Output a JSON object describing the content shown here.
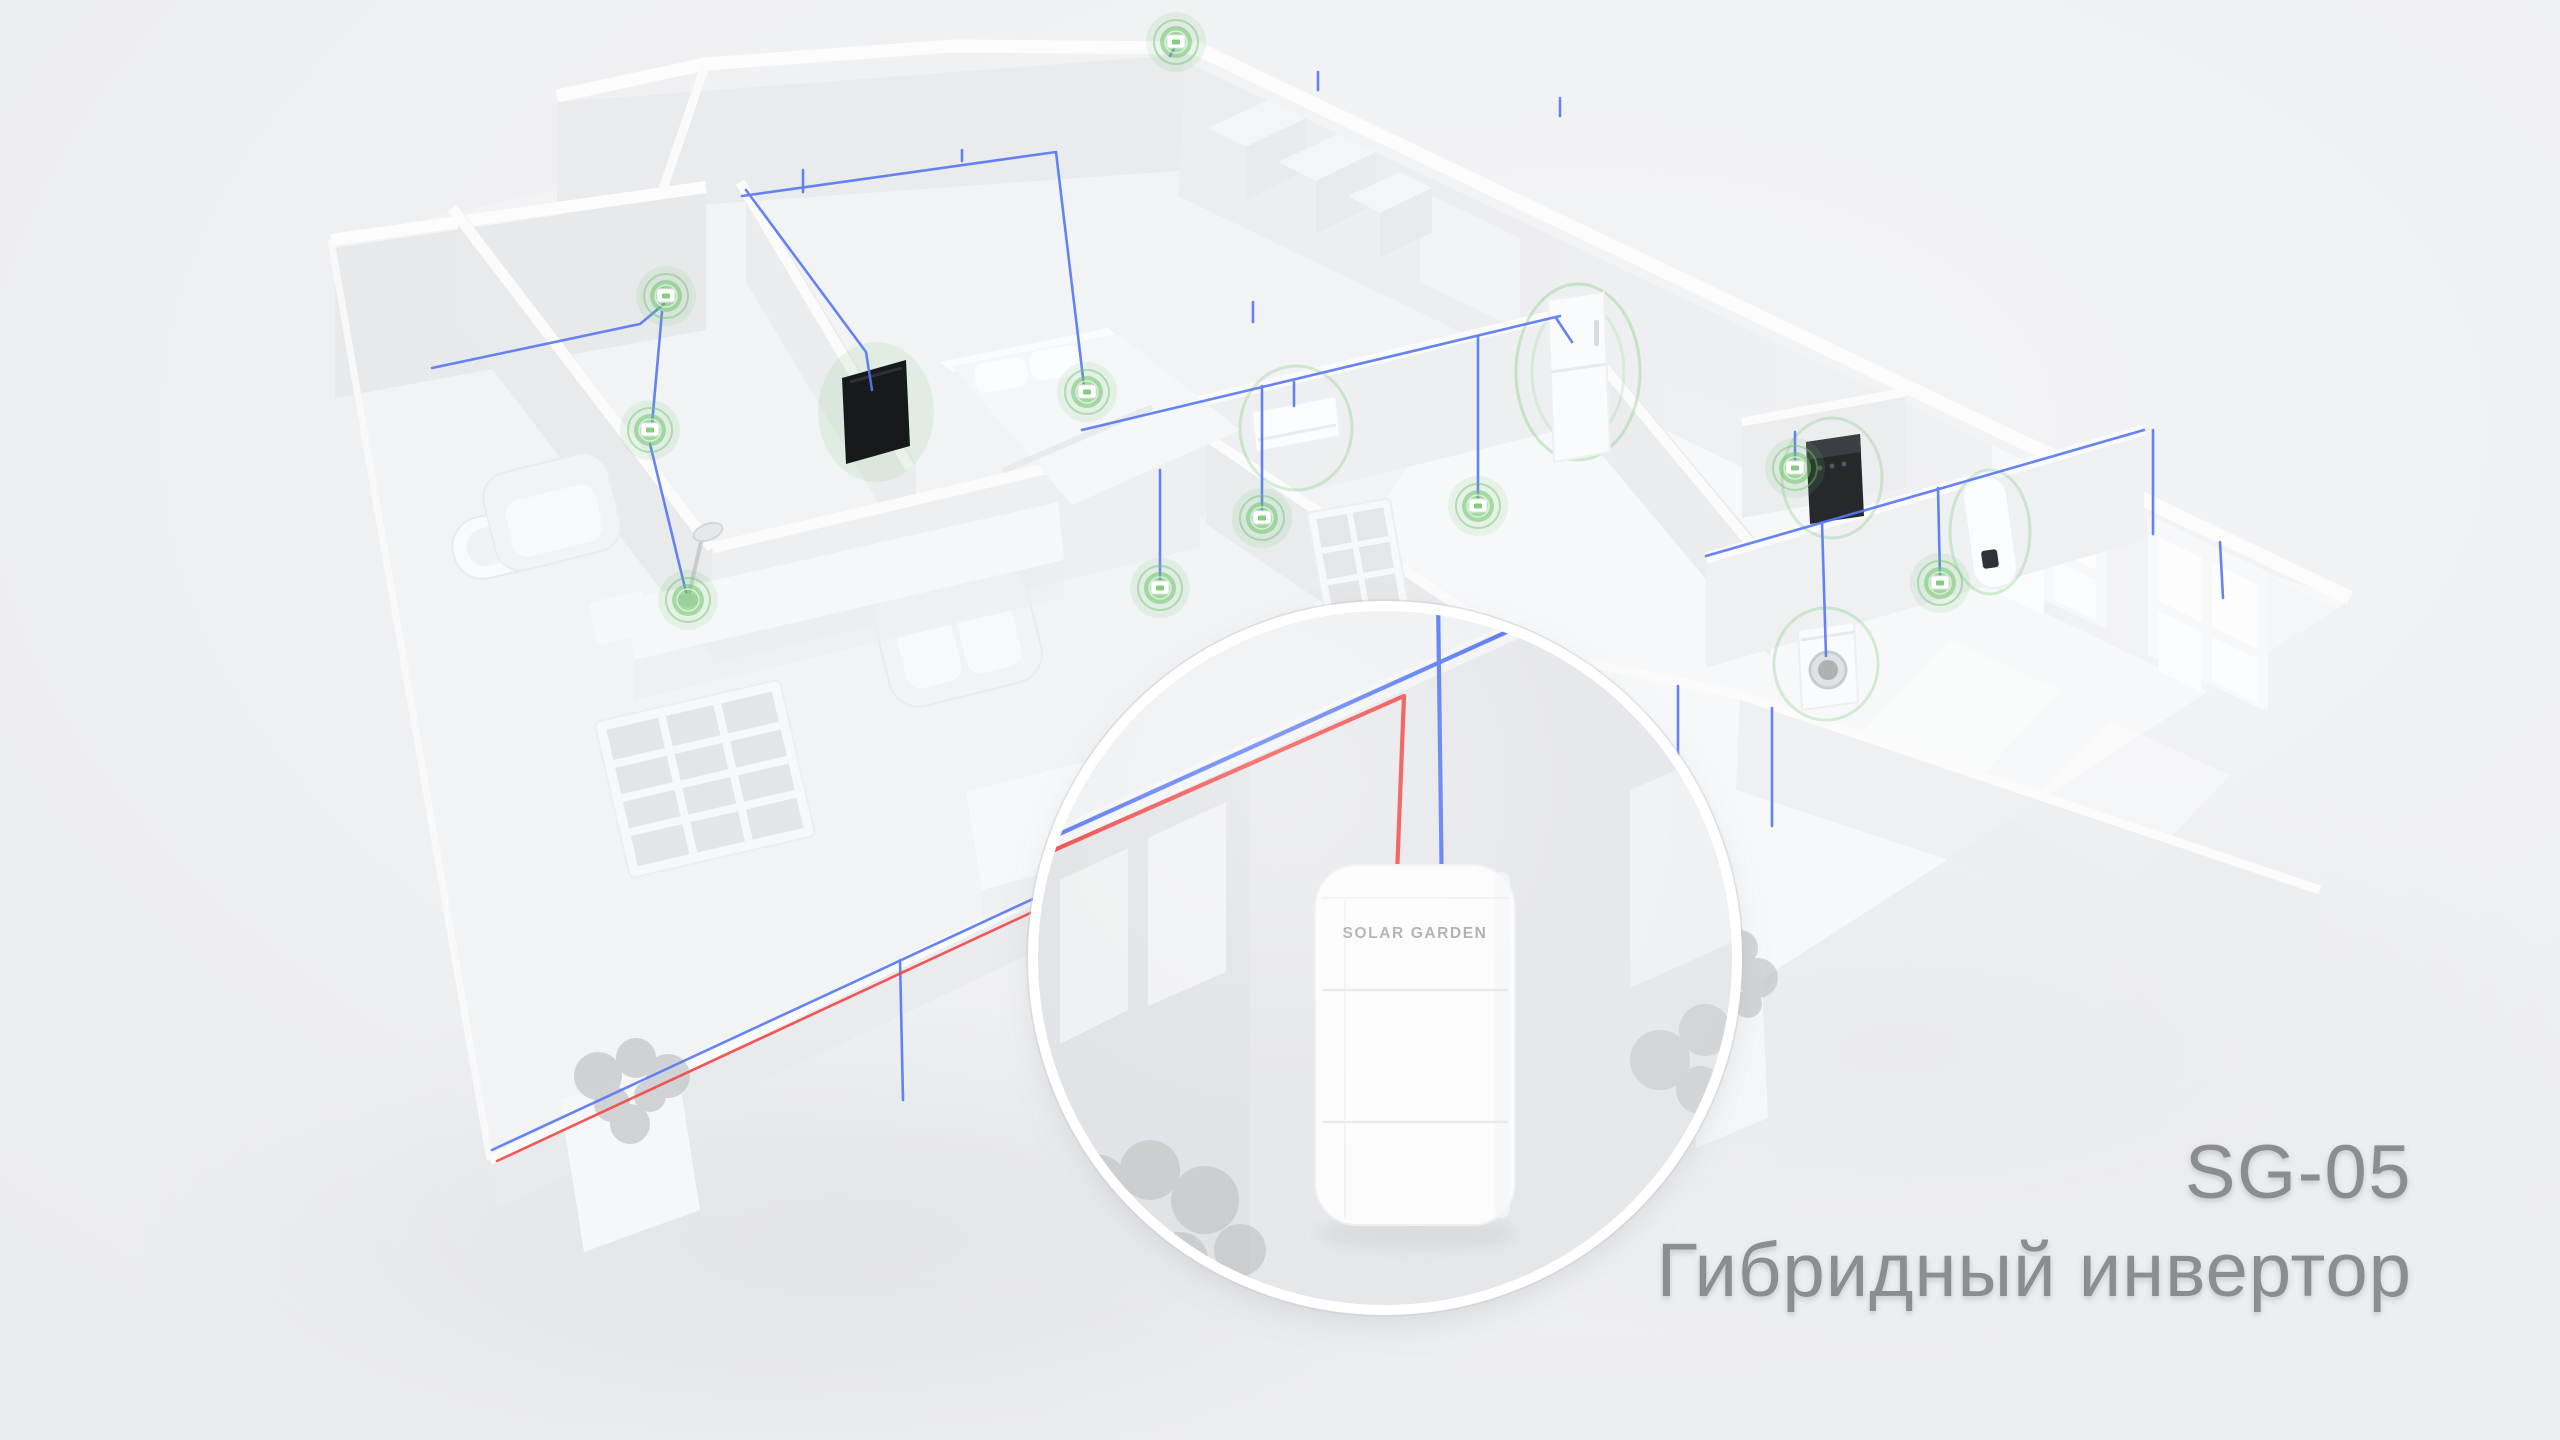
{
  "scene": {
    "background": "#eff0f2",
    "caption": {
      "model": "SG-05",
      "product": "Гибридный инвертор",
      "color": "#8c8d8f"
    },
    "inverter": {
      "brand": "SOLAR GARDEN",
      "brand_color": "#a8abad",
      "status_dots": [
        "#84c77e",
        "#bdc0c2",
        "#bdc0c2"
      ],
      "battery_leds": [
        {
          "charge": 1
        },
        {
          "charge": 0.68
        }
      ],
      "led_color": "#7dc877",
      "led_base_color": "#a4a6a9"
    },
    "wiring": {
      "ac_color": "#5577f2",
      "pv_color": "#ef4644"
    },
    "smart_nodes": {
      "color": "#6fc46a",
      "items": [
        {
          "x": 666,
          "y": 296
        },
        {
          "x": 650,
          "y": 430
        },
        {
          "x": 688,
          "y": 600,
          "ring_only": true
        },
        {
          "x": 1087,
          "y": 392
        },
        {
          "x": 1176,
          "y": 42
        },
        {
          "x": 1160,
          "y": 588
        },
        {
          "x": 1262,
          "y": 518
        },
        {
          "x": 1478,
          "y": 506
        },
        {
          "x": 1795,
          "y": 468
        },
        {
          "x": 1940,
          "y": 583
        }
      ]
    },
    "ceiling_lights": {
      "color": "#ecd979",
      "items": [
        {
          "x": 803,
          "y": 200
        },
        {
          "x": 962,
          "y": 168
        },
        {
          "x": 1318,
          "y": 96
        },
        {
          "x": 1560,
          "y": 122
        },
        {
          "x": 1008,
          "y": 333
        },
        {
          "x": 1253,
          "y": 327
        },
        {
          "x": 2153,
          "y": 540
        },
        {
          "x": 2223,
          "y": 604
        },
        {
          "x": 1678,
          "y": 778
        },
        {
          "x": 1772,
          "y": 832
        },
        {
          "x": 903,
          "y": 1109
        }
      ]
    }
  }
}
